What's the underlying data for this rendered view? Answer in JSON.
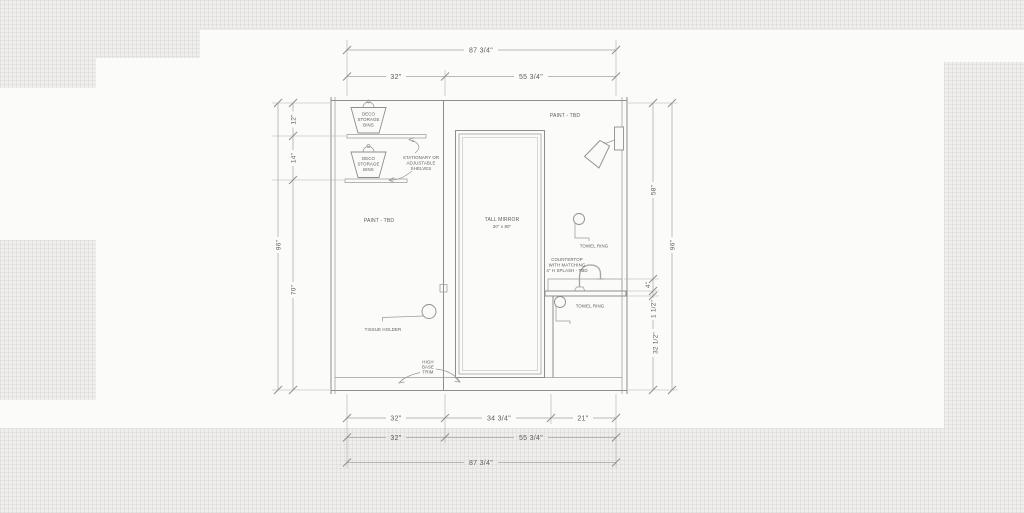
{
  "drawing": {
    "dims_top": {
      "overall": "87 3/4\"",
      "seg_left": "32\"",
      "seg_right": "55 3/4\""
    },
    "dims_bottom": {
      "seg1": "32\"",
      "seg2": "34 3/4\"",
      "seg3": "21\"",
      "row2_left": "32\"",
      "row2_right": "55 3/4\"",
      "overall": "87 3/4\""
    },
    "dims_left": {
      "top": "12\"",
      "mid": "14\"",
      "lower": "70\"",
      "overall": "96\""
    },
    "dims_right": {
      "upper": "58\"",
      "splash": "4\"",
      "counter": "1 1/2\"",
      "lower": "32 1/2\"",
      "overall": "96\""
    },
    "labels": {
      "bin1": [
        "DECO",
        "STORAGE",
        "BINS"
      ],
      "bin2": [
        "DECO",
        "STORAGE",
        "BINS"
      ],
      "shelves": [
        "STATIONARY OR",
        "ADJUSTABLE",
        "SHELVES"
      ],
      "paint_left": "PAINT - TBD",
      "paint_right": "PAINT - TBD",
      "mirror_title": "TALL MIRROR",
      "mirror_size": "30\" x 80\"",
      "towel_ring_upper": "TOWEL RING",
      "towel_ring_lower": "TOWEL RING",
      "countertop": [
        "COUNTERTOP",
        "WITH MATCHING",
        "4\" H SPLASH - TBD"
      ],
      "tissue_holder": "TISSUE HOLDER",
      "base_trim": [
        "HIGH",
        "BASE",
        "TRIM"
      ]
    },
    "colors": {
      "paper": "#efeeec",
      "linework": "#8e8e8a",
      "dimension": "#a4a39e",
      "text": "#5d5c56"
    }
  }
}
